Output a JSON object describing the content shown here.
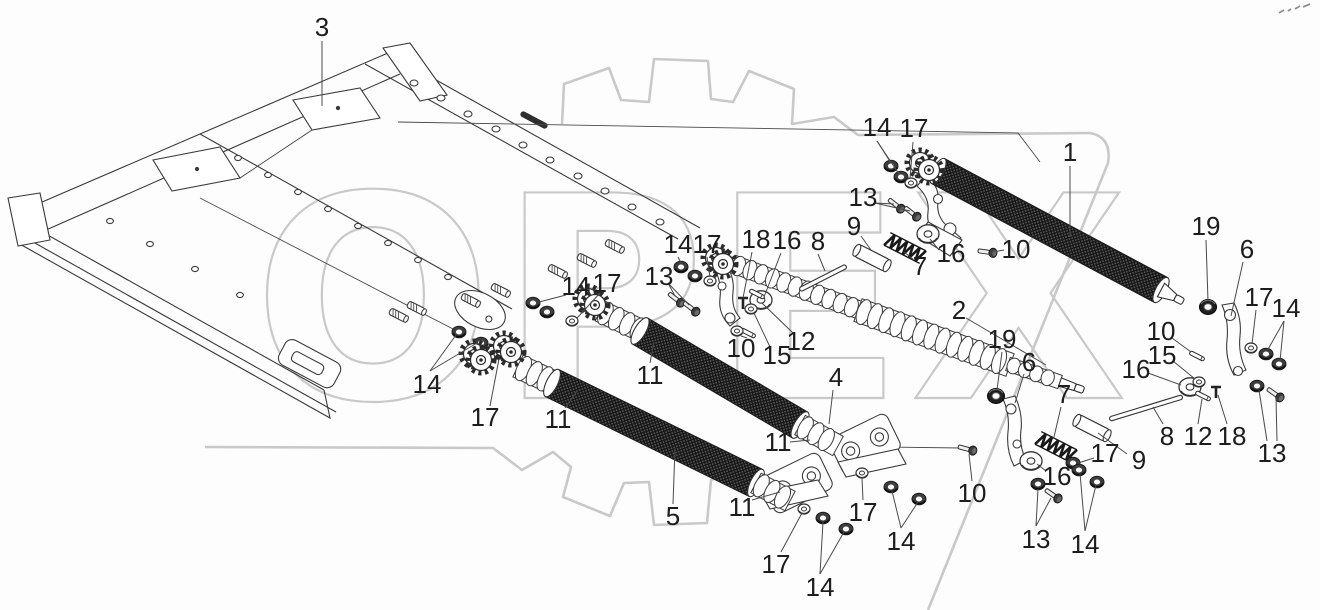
{
  "watermark": {
    "text": "ОРЕХ",
    "color": "#c9c9c9"
  },
  "colors": {
    "line": "#3a3a3a",
    "leader": "#4a4a4a",
    "label": "#1d1d1d",
    "background": "#fdfdfd",
    "watermark": "#c9c9c9",
    "knurl_dark": "#181818"
  },
  "callouts": [
    {
      "label": "3",
      "x": 322,
      "y": 27,
      "leaders": [
        [
          322,
          41,
          322,
          106
        ]
      ]
    },
    {
      "label": "14",
      "x": 877,
      "y": 127,
      "leaders": [
        [
          877,
          141,
          891,
          163
        ],
        [
          877,
          141,
          899,
          174
        ]
      ]
    },
    {
      "label": "17",
      "x": 914,
      "y": 128,
      "leaders": [
        [
          913,
          142,
          910,
          179
        ]
      ]
    },
    {
      "label": "1",
      "x": 1070,
      "y": 152,
      "leaders": [
        [
          1070,
          166,
          1070,
          237
        ]
      ]
    },
    {
      "label": "13",
      "x": 863,
      "y": 197,
      "leaders": [
        [
          875,
          203,
          894,
          204
        ],
        [
          875,
          203,
          910,
          211
        ]
      ]
    },
    {
      "label": "9",
      "x": 854,
      "y": 226,
      "leaders": [
        [
          861,
          236,
          871,
          250
        ]
      ]
    },
    {
      "label": "16",
      "x": 951,
      "y": 253,
      "leaders": [
        [
          939,
          250,
          930,
          239
        ]
      ]
    },
    {
      "label": "7",
      "x": 920,
      "y": 266,
      "leaders": [
        [
          913,
          259,
          904,
          252
        ]
      ]
    },
    {
      "label": "10",
      "x": 1016,
      "y": 249,
      "leaders": [
        [
          1004,
          250,
          993,
          252
        ]
      ]
    },
    {
      "label": "2",
      "x": 959,
      "y": 310,
      "leaders": [
        [
          966,
          318,
          1046,
          365
        ]
      ]
    },
    {
      "label": "19",
      "x": 1206,
      "y": 226,
      "leaders": [
        [
          1206,
          240,
          1208,
          301
        ]
      ]
    },
    {
      "label": "6",
      "x": 1247,
      "y": 249,
      "leaders": [
        [
          1243,
          262,
          1231,
          316
        ]
      ]
    },
    {
      "label": "17",
      "x": 1259,
      "y": 297,
      "leaders": [
        [
          1256,
          310,
          1252,
          344
        ]
      ]
    },
    {
      "label": "14",
      "x": 1286,
      "y": 308,
      "leaders": [
        [
          1284,
          321,
          1267,
          351
        ],
        [
          1284,
          321,
          1280,
          361
        ]
      ]
    },
    {
      "label": "18",
      "x": 756,
      "y": 239,
      "leaders": [
        [
          752,
          252,
          743,
          298
        ]
      ]
    },
    {
      "label": "16",
      "x": 787,
      "y": 240,
      "leaders": [
        [
          781,
          253,
          764,
          297
        ]
      ]
    },
    {
      "label": "8",
      "x": 818,
      "y": 241,
      "leaders": [
        [
          818,
          254,
          825,
          271
        ]
      ]
    },
    {
      "label": "14",
      "x": 678,
      "y": 244,
      "leaders": [
        [
          678,
          257,
          681,
          263
        ]
      ]
    },
    {
      "label": "17",
      "x": 707,
      "y": 244,
      "leaders": [
        [
          707,
          257,
          710,
          277
        ]
      ]
    },
    {
      "label": "13",
      "x": 659,
      "y": 276,
      "leaders": [
        [
          668,
          283,
          675,
          296
        ],
        [
          668,
          283,
          689,
          305
        ]
      ]
    },
    {
      "label": "14",
      "x": 576,
      "y": 286,
      "leaders": [
        [
          566,
          295,
          539,
          302
        ]
      ]
    },
    {
      "label": "17",
      "x": 607,
      "y": 283,
      "leaders": [
        [
          600,
          293,
          577,
          318
        ]
      ]
    },
    {
      "label": "12",
      "x": 801,
      "y": 341,
      "leaders": [
        [
          793,
          333,
          762,
          303
        ]
      ]
    },
    {
      "label": "15",
      "x": 777,
      "y": 355,
      "leaders": [
        [
          770,
          347,
          754,
          313
        ]
      ]
    },
    {
      "label": "10",
      "x": 741,
      "y": 348,
      "leaders": [
        [
          741,
          336,
          747,
          338
        ]
      ]
    },
    {
      "label": "11",
      "x": 650,
      "y": 375,
      "leaders": [
        [
          650,
          363,
          654,
          342
        ]
      ]
    },
    {
      "label": "4",
      "x": 836,
      "y": 377,
      "leaders": [
        [
          833,
          390,
          829,
          424
        ]
      ]
    },
    {
      "label": "14",
      "x": 427,
      "y": 384,
      "leaders": [
        [
          430,
          371,
          456,
          335
        ],
        [
          430,
          371,
          477,
          343
        ]
      ]
    },
    {
      "label": "17",
      "x": 485,
      "y": 417,
      "leaders": [
        [
          490,
          406,
          499,
          359
        ]
      ]
    },
    {
      "label": "11",
      "x": 558,
      "y": 419,
      "leaders": [
        [
          565,
          408,
          577,
          391
        ]
      ]
    },
    {
      "label": "5",
      "x": 673,
      "y": 516,
      "leaders": [
        [
          673,
          504,
          675,
          448
        ]
      ]
    },
    {
      "label": "11",
      "x": 742,
      "y": 507,
      "leaders": [
        [
          752,
          500,
          780,
          492
        ]
      ]
    },
    {
      "label": "11",
      "x": 778,
      "y": 442,
      "leaders": [
        [
          790,
          442,
          810,
          440
        ]
      ]
    },
    {
      "label": "17",
      "x": 776,
      "y": 564,
      "leaders": [
        [
          781,
          552,
          802,
          513
        ]
      ]
    },
    {
      "label": "14",
      "x": 820,
      "y": 587,
      "leaders": [
        [
          820,
          574,
          823,
          522
        ],
        [
          820,
          574,
          844,
          532
        ]
      ]
    },
    {
      "label": "17",
      "x": 863,
      "y": 512,
      "leaders": [
        [
          863,
          500,
          862,
          478
        ]
      ]
    },
    {
      "label": "14",
      "x": 901,
      "y": 541,
      "leaders": [
        [
          901,
          528,
          892,
          491
        ],
        [
          901,
          528,
          918,
          502
        ]
      ]
    },
    {
      "label": "10",
      "x": 972,
      "y": 493,
      "leaders": [
        [
          972,
          481,
          969,
          454
        ]
      ]
    },
    {
      "label": "13",
      "x": 1036,
      "y": 539,
      "leaders": [
        [
          1036,
          526,
          1038,
          489
        ],
        [
          1036,
          526,
          1051,
          498
        ]
      ]
    },
    {
      "label": "16",
      "x": 1057,
      "y": 476,
      "leaders": [
        [
          1046,
          471,
          1037,
          464
        ]
      ]
    },
    {
      "label": "7",
      "x": 1064,
      "y": 394,
      "leaders": [
        [
          1061,
          407,
          1054,
          437
        ]
      ]
    },
    {
      "label": "19",
      "x": 1002,
      "y": 339,
      "leaders": [
        [
          1002,
          352,
          997,
          390
        ]
      ]
    },
    {
      "label": "6",
      "x": 1029,
      "y": 362,
      "leaders": [
        [
          1024,
          374,
          1015,
          403
        ]
      ]
    },
    {
      "label": "9",
      "x": 1139,
      "y": 460,
      "leaders": [
        [
          1127,
          454,
          1098,
          433
        ]
      ]
    },
    {
      "label": "8",
      "x": 1167,
      "y": 436,
      "leaders": [
        [
          1163,
          424,
          1153,
          407
        ]
      ]
    },
    {
      "label": "12",
      "x": 1198,
      "y": 436,
      "leaders": [
        [
          1198,
          424,
          1202,
          399
        ]
      ]
    },
    {
      "label": "18",
      "x": 1232,
      "y": 436,
      "leaders": [
        [
          1227,
          424,
          1218,
          395
        ]
      ]
    },
    {
      "label": "13",
      "x": 1272,
      "y": 453,
      "leaders": [
        [
          1267,
          441,
          1259,
          390
        ],
        [
          1277,
          441,
          1276,
          398
        ]
      ]
    },
    {
      "label": "10",
      "x": 1161,
      "y": 331,
      "leaders": [
        [
          1172,
          338,
          1191,
          352
        ]
      ]
    },
    {
      "label": "15",
      "x": 1162,
      "y": 355,
      "leaders": [
        [
          1173,
          361,
          1195,
          379
        ]
      ]
    },
    {
      "label": "16",
      "x": 1136,
      "y": 369,
      "leaders": [
        [
          1148,
          373,
          1181,
          385
        ]
      ]
    },
    {
      "label": "17",
      "x": 1105,
      "y": 453,
      "leaders": [
        [
          1094,
          458,
          1078,
          463
        ]
      ]
    },
    {
      "label": "14",
      "x": 1085,
      "y": 544,
      "leaders": [
        [
          1085,
          531,
          1080,
          473
        ],
        [
          1085,
          531,
          1096,
          485
        ]
      ]
    }
  ],
  "rollers": [
    {
      "name": "roller-1",
      "type": "knurl",
      "x1": 938,
      "y1": 171,
      "x2": 1161,
      "y2": 290,
      "w": 14,
      "cone": true
    },
    {
      "name": "shaft-2-a",
      "type": "wavy",
      "x1": 733,
      "y1": 264,
      "x2": 862,
      "y2": 311,
      "w": 10
    },
    {
      "name": "shaft-2-b",
      "type": "wavy",
      "x1": 858,
      "y1": 310,
      "x2": 1010,
      "y2": 365,
      "w": 13
    },
    {
      "name": "shaft-2-c",
      "type": "wavy",
      "x1": 1008,
      "y1": 364,
      "x2": 1060,
      "y2": 382,
      "w": 8,
      "cone": true
    },
    {
      "name": "roller-4-left",
      "type": "wavy",
      "x1": 600,
      "y1": 311,
      "x2": 642,
      "y2": 331,
      "w": 12
    },
    {
      "name": "roller-4",
      "type": "knurl",
      "x1": 640,
      "y1": 331,
      "x2": 800,
      "y2": 425,
      "w": 15
    },
    {
      "name": "roller-4-right",
      "type": "wavy",
      "x1": 800,
      "y1": 425,
      "x2": 838,
      "y2": 446,
      "w": 12
    },
    {
      "name": "roller-5-left",
      "type": "wavy",
      "x1": 518,
      "y1": 366,
      "x2": 554,
      "y2": 383,
      "w": 13
    },
    {
      "name": "roller-5",
      "type": "knurl",
      "x1": 552,
      "y1": 383,
      "x2": 756,
      "y2": 483,
      "w": 15
    },
    {
      "name": "roller-5-right",
      "type": "wavy",
      "x1": 756,
      "y1": 483,
      "x2": 790,
      "y2": 501,
      "w": 12
    }
  ],
  "parts": [
    {
      "t": "nut",
      "x": 891,
      "y": 166
    },
    {
      "t": "nut",
      "x": 901,
      "y": 177
    },
    {
      "t": "washer",
      "x": 911,
      "y": 183
    },
    {
      "t": "bolt",
      "x": 896,
      "y": 205,
      "r": 38
    },
    {
      "t": "bolt",
      "x": 912,
      "y": 213,
      "r": 38
    },
    {
      "t": "washerBig",
      "x": 928,
      "y": 234
    },
    {
      "t": "spring",
      "x": 905,
      "y": 248,
      "r": 27
    },
    {
      "t": "tube",
      "x": 872,
      "y": 258,
      "r": 27
    },
    {
      "t": "rod",
      "x": 823,
      "y": 278,
      "r": -27,
      "len": 52
    },
    {
      "t": "bolt",
      "x": 987,
      "y": 252,
      "r": 8
    },
    {
      "t": "sprocket",
      "x": 920,
      "y": 163
    },
    {
      "t": "sprocket",
      "x": 929,
      "y": 170
    },
    {
      "t": "nut",
      "x": 681,
      "y": 267
    },
    {
      "t": "nut",
      "x": 695,
      "y": 276
    },
    {
      "t": "washer",
      "x": 710,
      "y": 281
    },
    {
      "t": "bolt",
      "x": 676,
      "y": 299,
      "r": 38
    },
    {
      "t": "bolt",
      "x": 691,
      "y": 308,
      "r": 38
    },
    {
      "t": "sprocket",
      "x": 716,
      "y": 258
    },
    {
      "t": "sprocket",
      "x": 723,
      "y": 264
    },
    {
      "t": "washerBig",
      "x": 761,
      "y": 300
    },
    {
      "t": "tpin",
      "x": 743,
      "y": 302
    },
    {
      "t": "pin",
      "x": 757,
      "y": 294,
      "r": 27
    },
    {
      "t": "washer",
      "x": 751,
      "y": 309
    },
    {
      "t": "pin",
      "x": 748,
      "y": 333,
      "r": 27
    },
    {
      "t": "washer",
      "x": 737,
      "y": 331
    },
    {
      "t": "nut",
      "x": 533,
      "y": 303
    },
    {
      "t": "nut",
      "x": 547,
      "y": 312
    },
    {
      "t": "washer",
      "x": 572,
      "y": 321
    },
    {
      "t": "nut",
      "x": 459,
      "y": 332
    },
    {
      "t": "nut",
      "x": 481,
      "y": 343
    },
    {
      "t": "washer",
      "x": 500,
      "y": 354
    },
    {
      "t": "stud",
      "x": 614,
      "y": 246,
      "r": 27
    },
    {
      "t": "stud",
      "x": 586,
      "y": 260,
      "r": 27
    },
    {
      "t": "stud",
      "x": 557,
      "y": 271,
      "r": 27
    },
    {
      "t": "stud",
      "x": 500,
      "y": 290,
      "r": 27
    },
    {
      "t": "stud",
      "x": 470,
      "y": 300,
      "r": 27
    },
    {
      "t": "stud",
      "x": 416,
      "y": 308,
      "r": 27
    },
    {
      "t": "stud",
      "x": 398,
      "y": 315,
      "r": 27
    },
    {
      "t": "sprocket",
      "x": 588,
      "y": 299
    },
    {
      "t": "sprocket",
      "x": 595,
      "y": 305
    },
    {
      "t": "sprocket",
      "x": 474,
      "y": 354
    },
    {
      "t": "sprocket",
      "x": 481,
      "y": 360
    },
    {
      "t": "sprocket",
      "x": 504,
      "y": 346
    },
    {
      "t": "sprocket",
      "x": 511,
      "y": 352
    },
    {
      "t": "washer",
      "x": 804,
      "y": 509
    },
    {
      "t": "nut",
      "x": 823,
      "y": 518
    },
    {
      "t": "nut",
      "x": 846,
      "y": 529
    },
    {
      "t": "washer",
      "x": 862,
      "y": 473
    },
    {
      "t": "nut",
      "x": 891,
      "y": 487
    },
    {
      "t": "nut",
      "x": 919,
      "y": 499
    },
    {
      "t": "bolt",
      "x": 967,
      "y": 449,
      "r": 15
    },
    {
      "t": "bearing",
      "x": 996,
      "y": 396
    },
    {
      "t": "washerBig",
      "x": 1031,
      "y": 461
    },
    {
      "t": "spring",
      "x": 1056,
      "y": 447,
      "r": 27
    },
    {
      "t": "nut",
      "x": 1073,
      "y": 463
    },
    {
      "t": "nut",
      "x": 1038,
      "y": 484
    },
    {
      "t": "bolt",
      "x": 1053,
      "y": 495,
      "r": 35
    },
    {
      "t": "nut",
      "x": 1079,
      "y": 470
    },
    {
      "t": "nut",
      "x": 1097,
      "y": 482
    },
    {
      "t": "tube",
      "x": 1092,
      "y": 428,
      "r": 27
    },
    {
      "t": "rod",
      "x": 1146,
      "y": 408,
      "r": -17,
      "len": 76
    },
    {
      "t": "washerBig",
      "x": 1190,
      "y": 387
    },
    {
      "t": "washer",
      "x": 1199,
      "y": 382
    },
    {
      "t": "pin",
      "x": 1197,
      "y": 356,
      "r": 27
    },
    {
      "t": "pin",
      "x": 1203,
      "y": 396,
      "r": 27
    },
    {
      "t": "tpin",
      "x": 1216,
      "y": 391
    },
    {
      "t": "bearing",
      "x": 1208,
      "y": 307
    },
    {
      "t": "washer",
      "x": 1251,
      "y": 348
    },
    {
      "t": "nut",
      "x": 1266,
      "y": 354
    },
    {
      "t": "nut",
      "x": 1279,
      "y": 364
    },
    {
      "t": "nut",
      "x": 1257,
      "y": 386
    },
    {
      "t": "bolt",
      "x": 1275,
      "y": 394,
      "r": 35
    }
  ],
  "corner_marks": [
    [
      1279,
      13,
      1284,
      10
    ],
    [
      1288,
      11,
      1291,
      9
    ],
    [
      1295,
      9,
      1300,
      6
    ],
    [
      1303,
      7,
      1310,
      4
    ]
  ]
}
